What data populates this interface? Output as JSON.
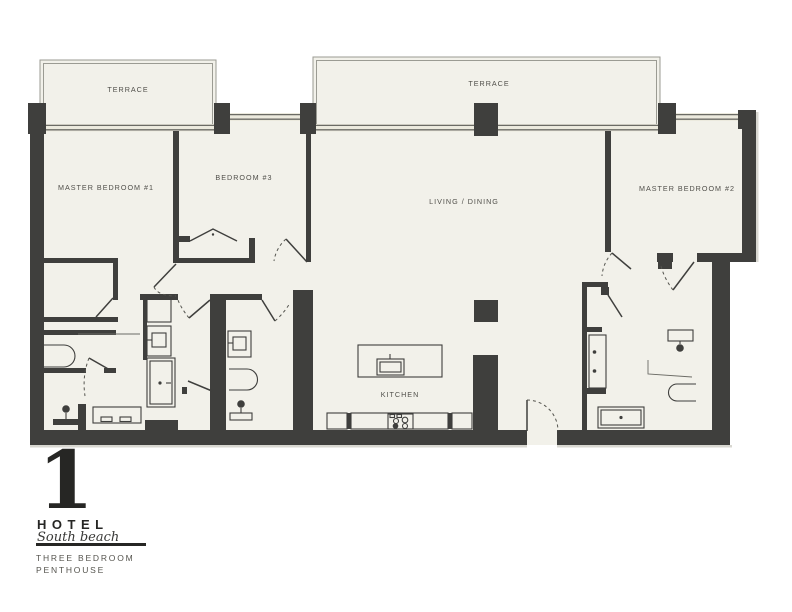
{
  "rooms": {
    "terrace_left": {
      "label": "TERRACE"
    },
    "terrace_right": {
      "label": "TERRACE"
    },
    "master_bedroom_1": {
      "label": "MASTER BEDROOM #1"
    },
    "bedroom_3": {
      "label": "BEDROOM #3"
    },
    "living_dining": {
      "label": "LIVING / DINING"
    },
    "master_bedroom_2": {
      "label": "MASTER BEDROOM #2"
    },
    "kitchen": {
      "label": "KITCHEN"
    }
  },
  "logo": {
    "numeral": "1",
    "brand": "HOTEL",
    "script": "South beach",
    "unit_line1": "THREE BEDROOM",
    "unit_line2": "PENTHOUSE"
  },
  "colors": {
    "background": "#ffffff",
    "floor": "#f2f1ea",
    "wall": "#3f3f3d",
    "window_line": "#6b6b65",
    "terrace_line": "#9b9b93",
    "label_text": "#504f4a",
    "logo_text": "#262624"
  }
}
